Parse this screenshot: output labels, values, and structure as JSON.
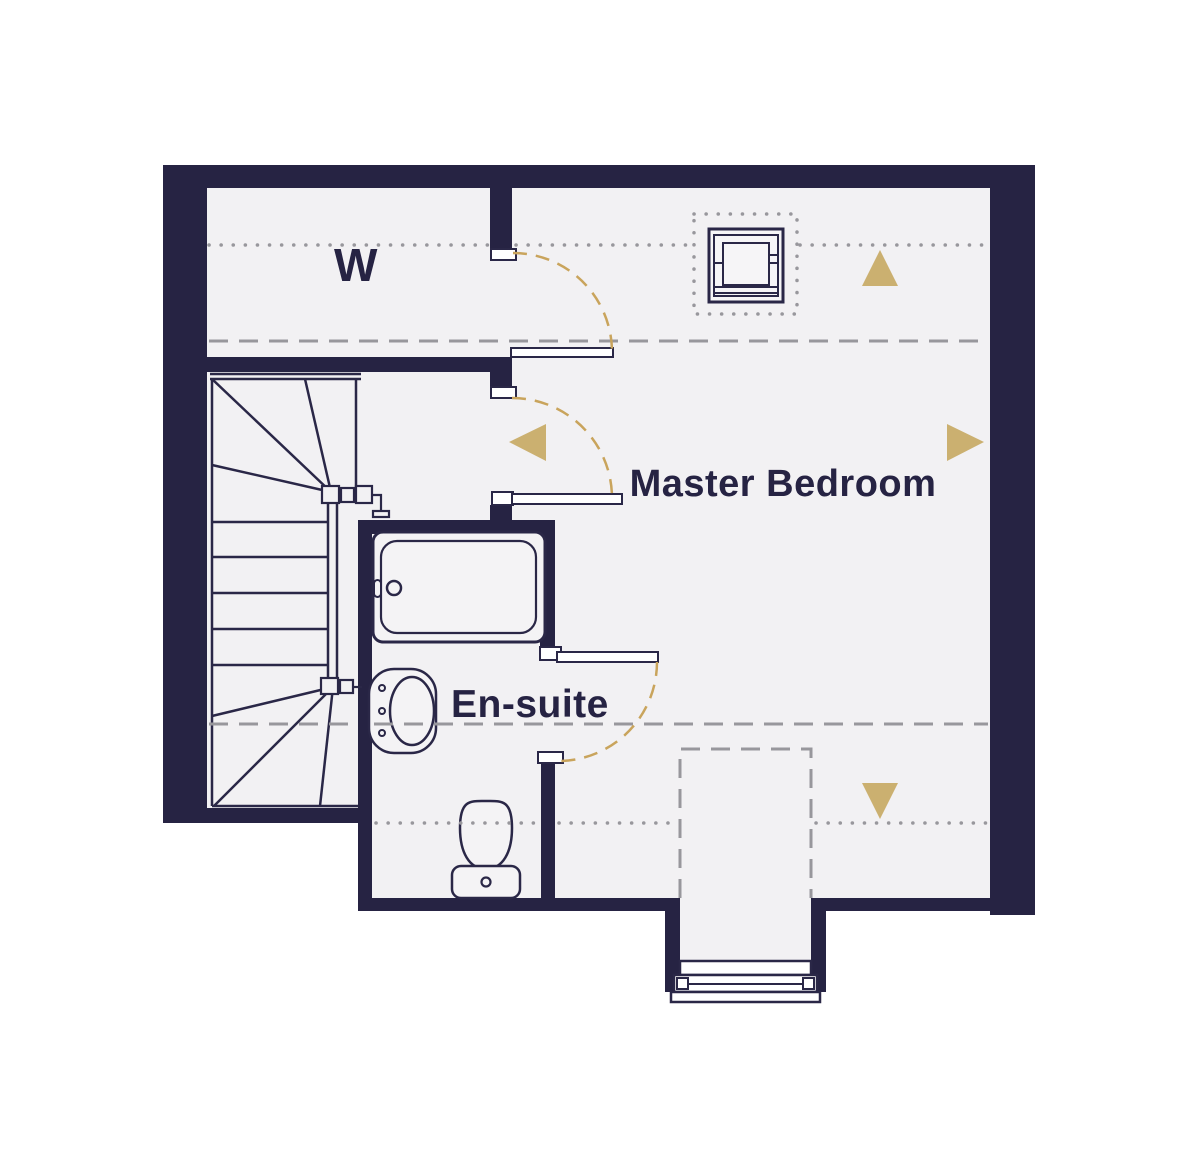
{
  "plan": {
    "title": "upper floor plan",
    "rooms": {
      "wardrobe_label": "W",
      "master_bedroom_label": "Master Bedroom",
      "ensuite_label": "En-suite"
    },
    "colors": {
      "wall": "#262343",
      "floor": "#f2f1f3",
      "fixture_line": "#2a2747",
      "guide_gray": "#98979c",
      "door_swing_gold": "#c9a45c",
      "roof_arrow_gold": "#cbb070",
      "background": "#ffffff"
    },
    "fixtures": [
      "staircase",
      "bathtub",
      "washbasin",
      "toilet",
      "skylight-window",
      "dormer-window"
    ],
    "doors": [
      "wardrobe-door",
      "bedroom-door",
      "ensuite-door"
    ],
    "guides": [
      "dotted-headroom-lines",
      "dashed-headroom-lines",
      "dormer-outline"
    ],
    "roof_slope_arrows": [
      "up",
      "right",
      "left",
      "down"
    ]
  }
}
